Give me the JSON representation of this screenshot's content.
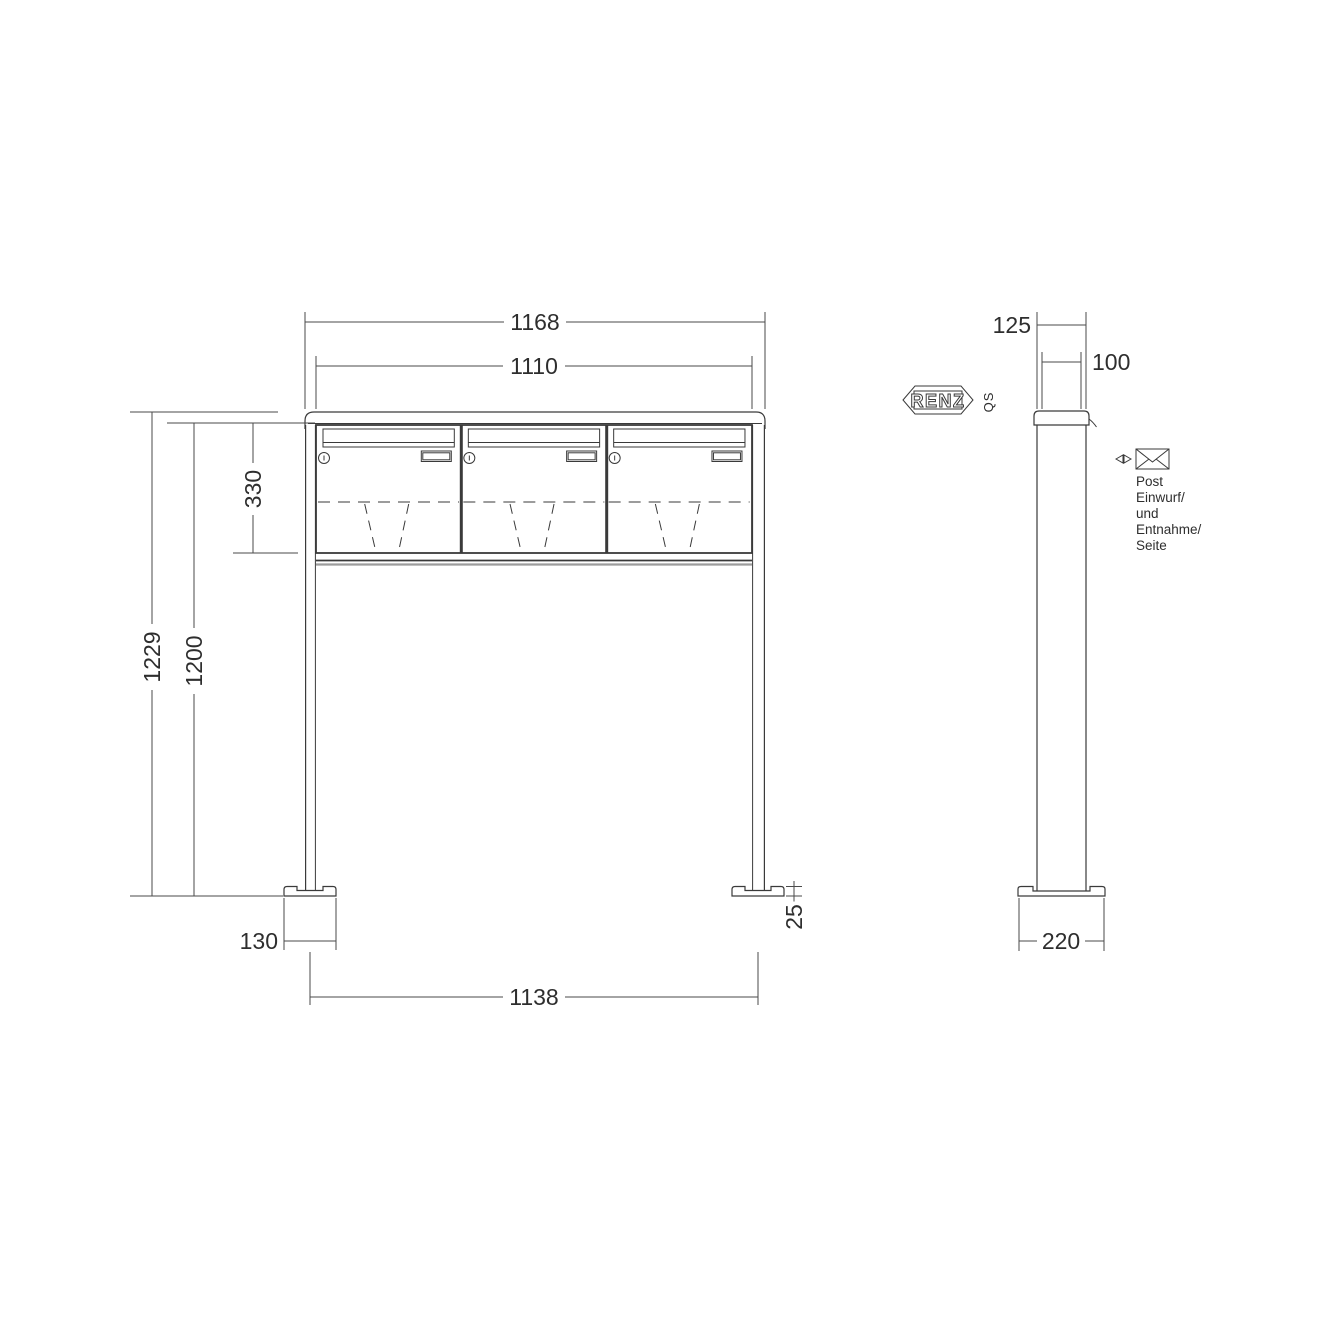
{
  "drawing": {
    "type": "technical-dimension-drawing",
    "subject": "free-standing letterbox unit, 3 compartments, front and side view"
  },
  "front_view": {
    "dims": {
      "overall_width": "1168",
      "box_width": "1110",
      "box_height": "330",
      "overall_height": "1229",
      "post_height": "1200",
      "foot_width": "130",
      "foot_plate_height": "25",
      "post_spacing": "1138"
    },
    "compartments": 3
  },
  "side_view": {
    "dims": {
      "overall_depth": "125",
      "post_depth": "100",
      "foot_depth": "220"
    }
  },
  "branding": {
    "logo_text": "RENZ",
    "qs_mark": "QS"
  },
  "annotation": {
    "lines": [
      "Post",
      "Einwurf/",
      "und",
      "Entnahme/",
      "Seite"
    ]
  },
  "colors": {
    "line": "#3a3a3a",
    "line_light": "#9c9c9c",
    "text": "#2e2e2e",
    "background": "#ffffff"
  }
}
